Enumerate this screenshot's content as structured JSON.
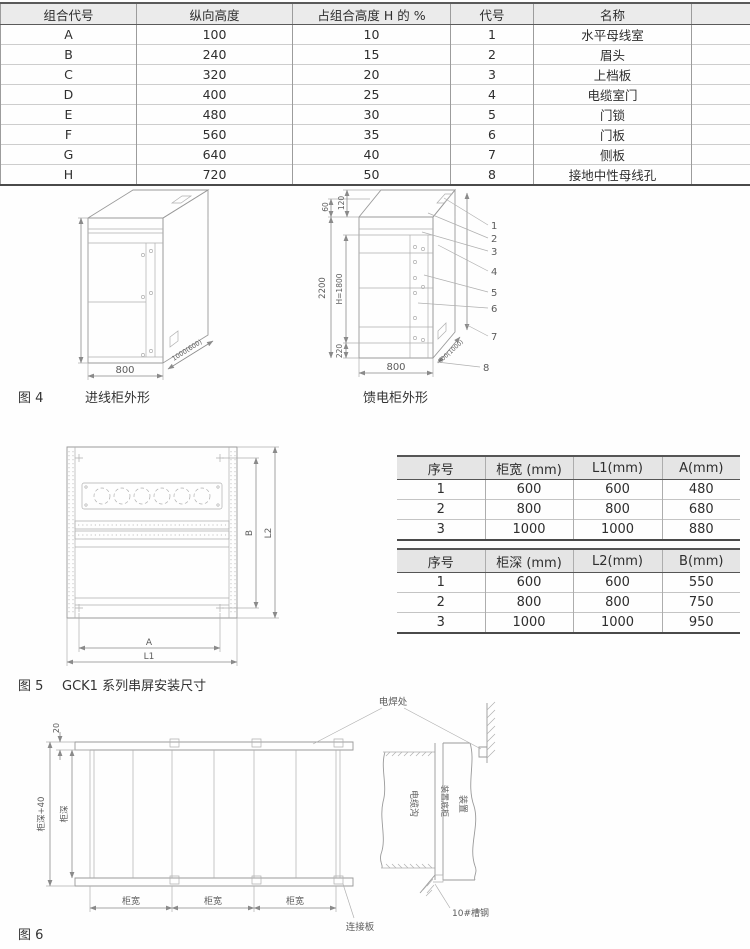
{
  "height_table": {
    "headers": [
      "组合代号",
      "纵向高度",
      "占组合高度 H 的 %",
      "代号",
      "名称"
    ],
    "rows": [
      [
        "A",
        "100",
        "10",
        "1",
        "水平母线室"
      ],
      [
        "B",
        "240",
        "15",
        "2",
        "眉头"
      ],
      [
        "C",
        "320",
        "20",
        "3",
        "上档板"
      ],
      [
        "D",
        "400",
        "25",
        "4",
        "电缆室门"
      ],
      [
        "E",
        "480",
        "30",
        "5",
        "门锁"
      ],
      [
        "F",
        "560",
        "35",
        "6",
        "门板"
      ],
      [
        "G",
        "640",
        "40",
        "7",
        "侧板"
      ],
      [
        "H",
        "720",
        "50",
        "8",
        "接地中性母线孔"
      ]
    ]
  },
  "fig4": {
    "number": "图 4",
    "incoming_label": "进线柜外形",
    "feeder_label": "馈电柜外形",
    "incoming": {
      "width": "800",
      "depth": "1000(600)"
    },
    "feeder": {
      "width": "800",
      "depth": "800(1000)",
      "total_height": "2200",
      "inner_height": "H=1800",
      "top_dim1": "60",
      "top_dim2": "120",
      "bottom_dim": "220",
      "callouts": [
        "1",
        "2",
        "3",
        "4",
        "5",
        "6",
        "7",
        "8"
      ]
    }
  },
  "fig5": {
    "number": "图 5",
    "title": "GCK1 系列串屏安装尺寸",
    "dim_a": "A",
    "dim_l1": "L1",
    "dim_b": "B",
    "dim_l2": "L2",
    "width_table": {
      "headers": [
        "序号",
        "柜宽 (mm)",
        "L1(mm)",
        "A(mm)"
      ],
      "rows": [
        [
          "1",
          "600",
          "600",
          "480"
        ],
        [
          "2",
          "800",
          "800",
          "680"
        ],
        [
          "3",
          "1000",
          "1000",
          "880"
        ]
      ]
    },
    "depth_table": {
      "headers": [
        "序号",
        "柜深 (mm)",
        "L2(mm)",
        "B(mm)"
      ],
      "rows": [
        [
          "1",
          "600",
          "600",
          "550"
        ],
        [
          "2",
          "800",
          "800",
          "750"
        ],
        [
          "3",
          "1000",
          "1000",
          "950"
        ]
      ]
    }
  },
  "fig6": {
    "number": "图 6",
    "weld_label": "电焊处",
    "gap_dim": "20",
    "depth_plus_dim": "柜深+40",
    "depth_dim": "柜深",
    "bay_dims": [
      "柜宽",
      "柜宽",
      "柜宽"
    ],
    "connector_label": "连接板",
    "trench_label": "电缆沟",
    "base_label": "装置底柜",
    "device_label": "装置",
    "channel_label": "10#槽钢"
  }
}
